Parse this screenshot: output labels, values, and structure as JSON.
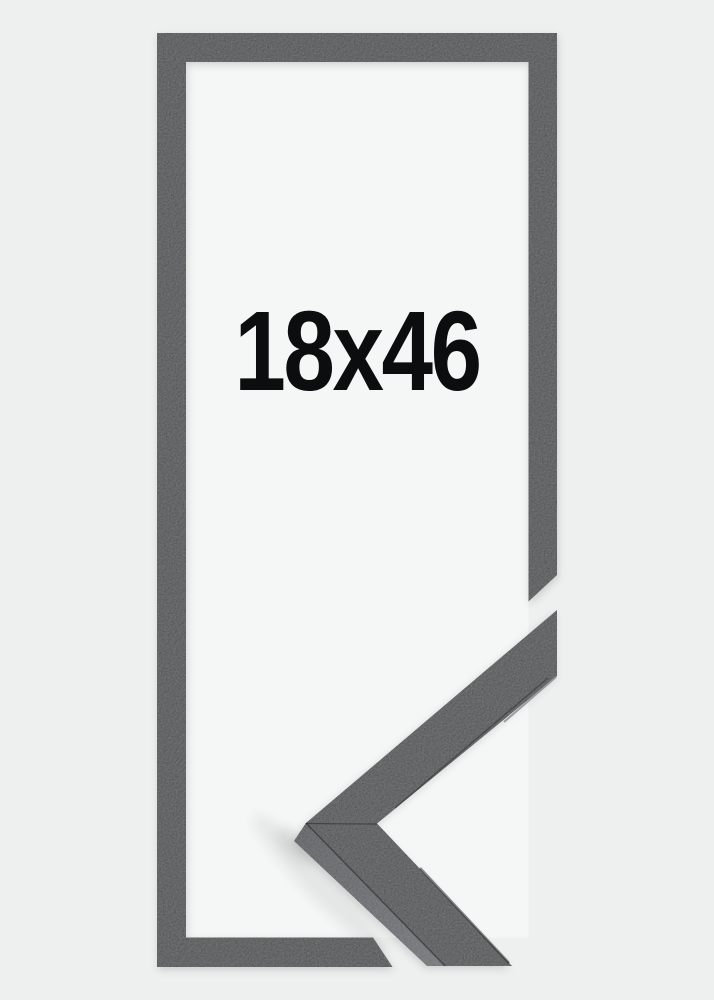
{
  "product": {
    "size_label": "18x46"
  },
  "colors": {
    "background": "#eef0f0",
    "frame": "#2c2e2f",
    "interior": "#f5f6f6",
    "label": "#0c0d0e",
    "detail_face": "#2f3132",
    "detail_side_dark": "#3e4042",
    "detail_side_light": "#616467",
    "edge_highlight": "#8d9092",
    "edge_shadow": "#17191a",
    "mitre_seam": "#1a1c1d"
  }
}
